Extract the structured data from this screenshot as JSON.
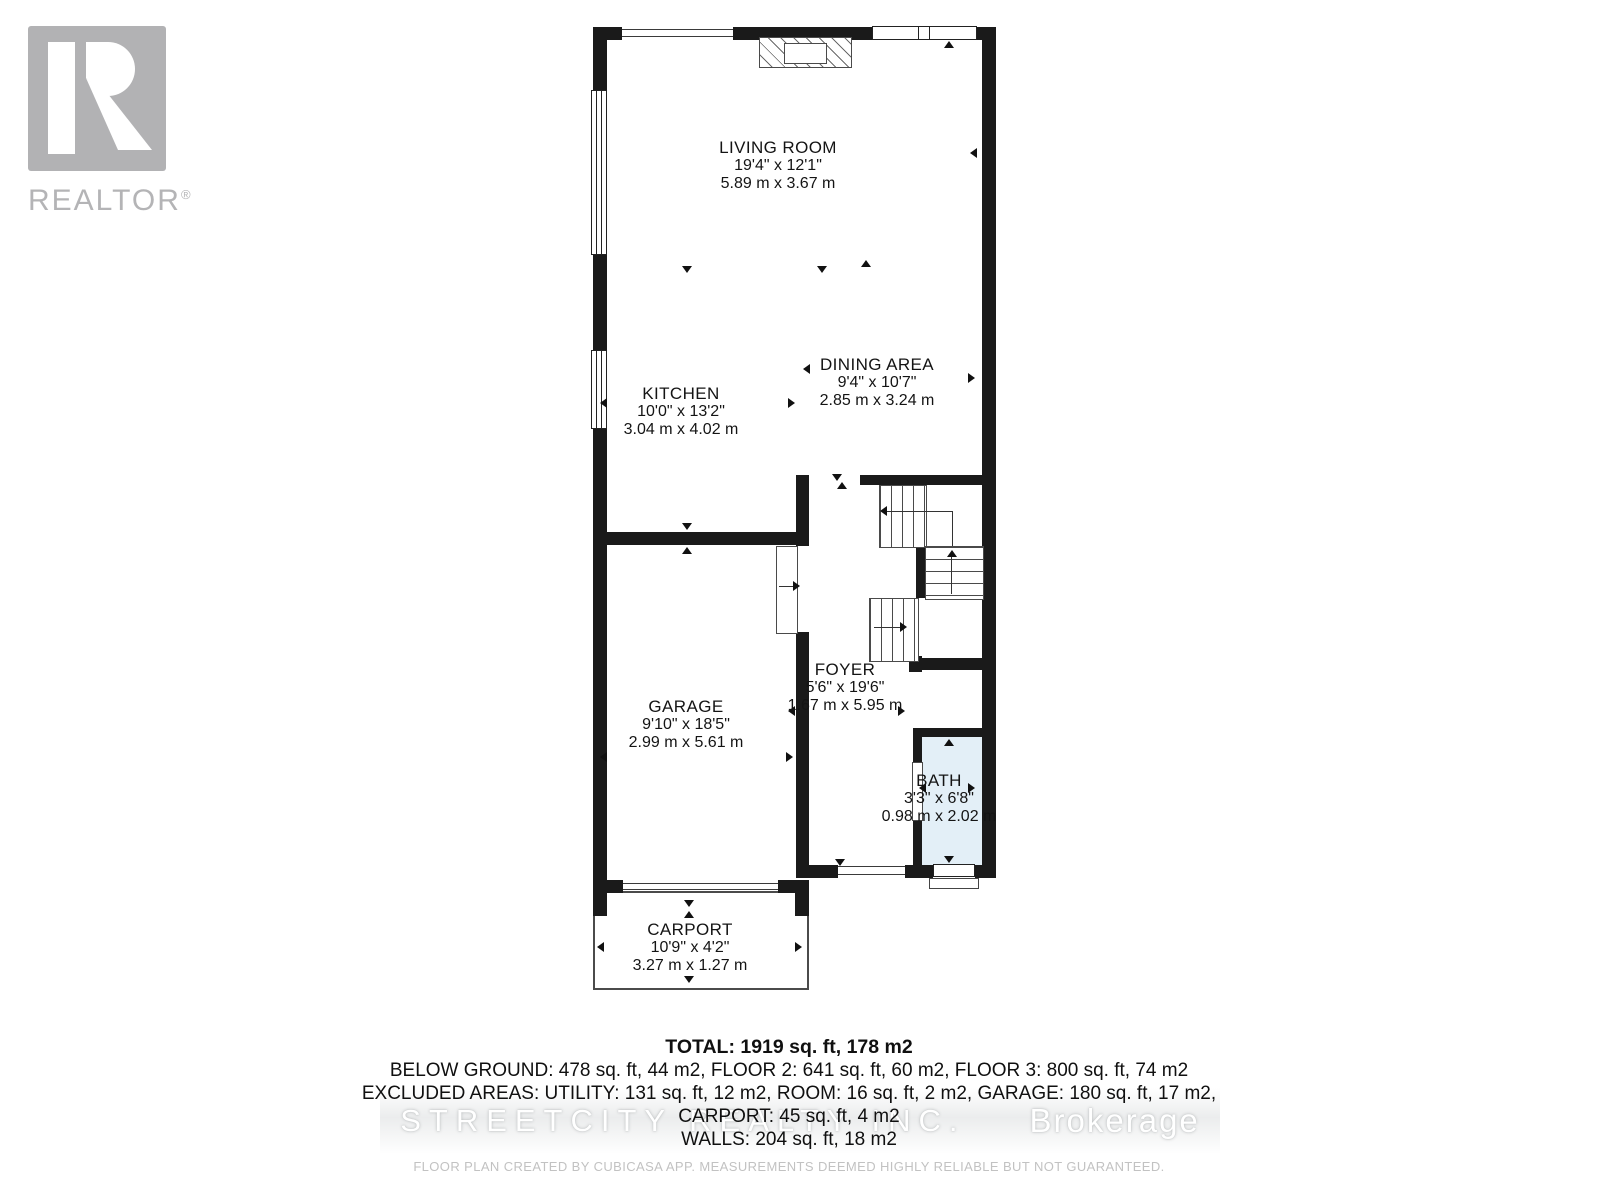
{
  "branding": {
    "logo_text": "REALTOR",
    "registered": "®"
  },
  "rooms": [
    {
      "id": "living-room",
      "name": "LIVING ROOM",
      "imperial": "19'4\" x 12'1\"",
      "metric": "5.89 m x 3.67 m"
    },
    {
      "id": "kitchen",
      "name": "KITCHEN",
      "imperial": "10'0\" x 13'2\"",
      "metric": "3.04 m x 4.02 m"
    },
    {
      "id": "dining-area",
      "name": "DINING AREA",
      "imperial": "9'4\" x 10'7\"",
      "metric": "2.85 m x 3.24 m"
    },
    {
      "id": "garage",
      "name": "GARAGE",
      "imperial": "9'10\" x 18'5\"",
      "metric": "2.99 m x 5.61 m"
    },
    {
      "id": "foyer",
      "name": "FOYER",
      "imperial": "5'6\" x 19'6\"",
      "metric": "1.67 m x 5.95 m"
    },
    {
      "id": "bath",
      "name": "BATH",
      "imperial": "3'3\" x 6'8\"",
      "metric": "0.98 m x 2.02 m"
    },
    {
      "id": "carport",
      "name": "CARPORT",
      "imperial": "10'9\" x 4'2\"",
      "metric": "3.27 m x 1.27 m"
    }
  ],
  "summary": {
    "total": "TOTAL: 1919 sq. ft, 178 m2",
    "floors": "BELOW GROUND: 478 sq. ft, 44 m2, FLOOR 2: 641 sq. ft, 60 m2, FLOOR 3: 800 sq. ft, 74 m2",
    "excluded": "EXCLUDED AREAS: UTILITY: 131 sq. ft, 12 m2, ROOM: 16 sq. ft, 2 m2, GARAGE: 180 sq. ft, 17 m2,",
    "carport": "CARPORT: 45 sq. ft, 4 m2",
    "walls": "WALLS: 204 sq. ft, 18 m2"
  },
  "watermark": {
    "brand": "STREETCITY REALTY INC.",
    "suffix": "Brokerage"
  },
  "disclaimer": "FLOOR PLAN CREATED BY CUBICASA APP. MEASUREMENTS DEEMED HIGHLY RELIABLE BUT NOT GUARANTEED.",
  "colors": {
    "wall": "#1a1a1a",
    "bath_fill": "#e3eff7",
    "logo_gray": "#b2b2b4",
    "watermark_gray": "#cbcfd1"
  },
  "icons": {
    "realtor_logo_icon": "stylized white R in gray square",
    "measure_arrow_icon": "small black triangle marker",
    "stair_direction_arrow_icon": "thin arrow showing stair direction"
  }
}
